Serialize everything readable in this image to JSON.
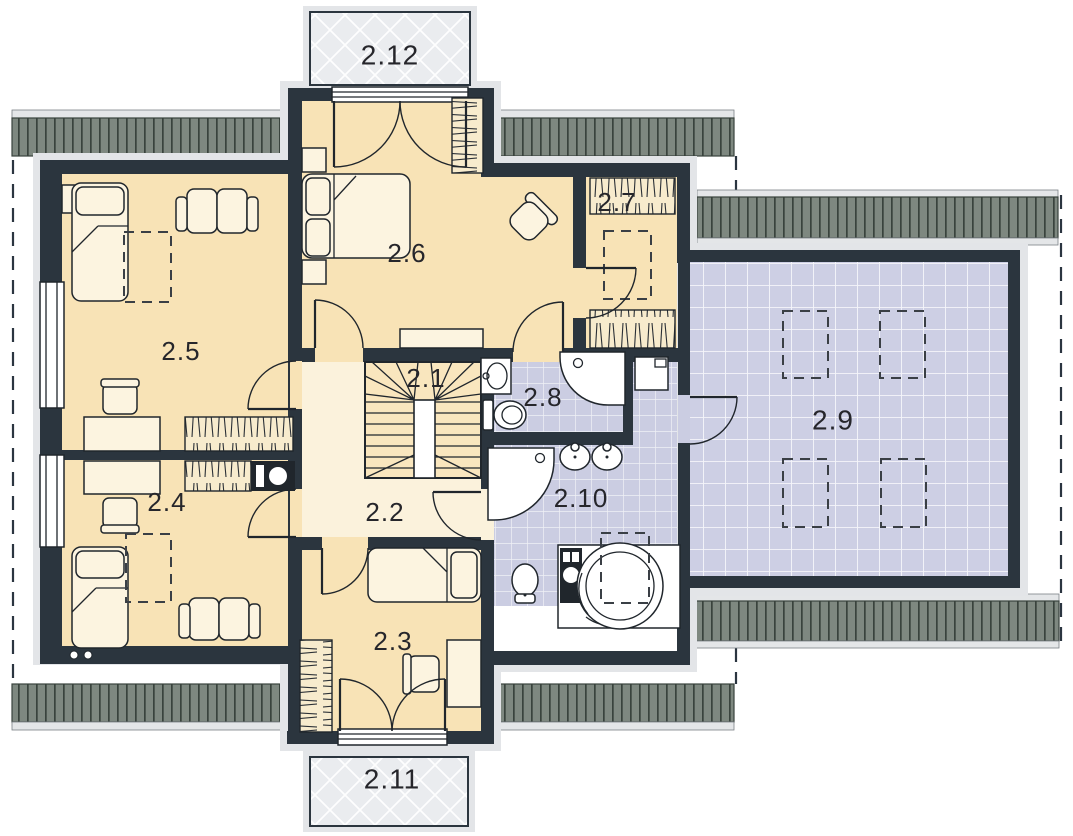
{
  "rooms": [
    {
      "label": "2.1"
    },
    {
      "label": "2.2"
    },
    {
      "label": "2.3"
    },
    {
      "label": "2.4"
    },
    {
      "label": "2.5"
    },
    {
      "label": "2.6"
    },
    {
      "label": "2.7"
    },
    {
      "label": "2.8"
    },
    {
      "label": "2.9"
    },
    {
      "label": "2.10"
    },
    {
      "label": "2.11"
    },
    {
      "label": "2.12"
    }
  ],
  "colors": {
    "wall": "#2B353E",
    "room_cream": "#F8E3B6",
    "hallway": "#FBF2DC",
    "wet_room_tile": "#CBCDE2",
    "attic_room_tile": "#CDCFE4",
    "roof": "#7E8880",
    "roof_line": "#39433D",
    "balcony": "#EAECEF",
    "exterior_outline": "#E3E5E8",
    "furniture": "#FCF4E0"
  }
}
